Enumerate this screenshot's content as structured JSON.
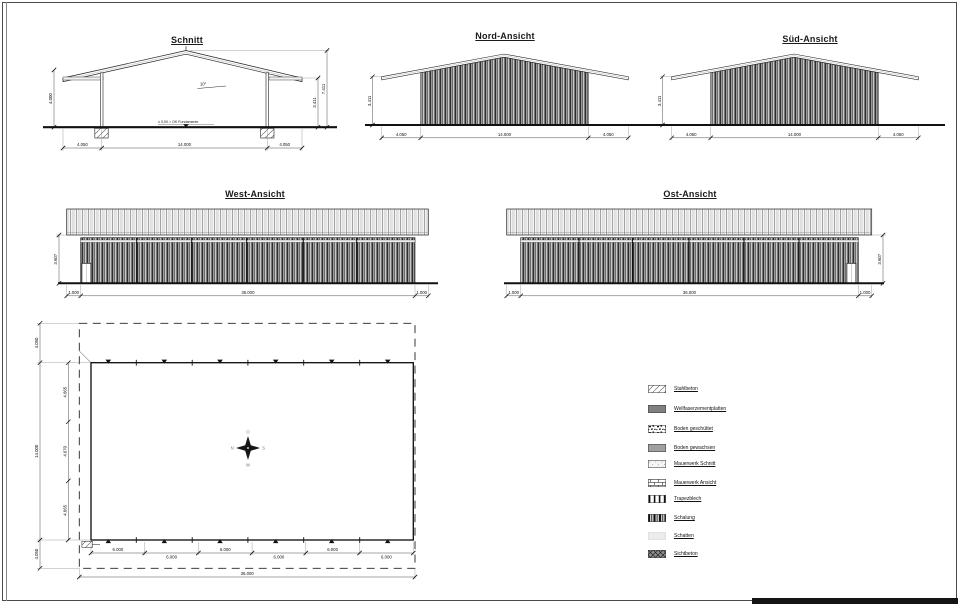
{
  "titles": {
    "schnitt": "Schnitt",
    "nord": "Nord-Ansicht",
    "sued": "Süd-Ansicht",
    "west": "West-Ansicht",
    "ost": "Ost-Ansicht",
    "grundriss": "Grundriss"
  },
  "schnitt": {
    "dims": {
      "bottom": [
        "4.050",
        "14.000",
        "4.050"
      ],
      "left": "4.000",
      "right_total": "7.411",
      "right_wall": "3.411"
    },
    "annotations": {
      "slope": "10°",
      "level": "± 0,00 = OK Fundamente"
    }
  },
  "nord": {
    "dims": {
      "bottom": [
        "4.050",
        "14.000",
        "4.050"
      ],
      "left": "3.411"
    }
  },
  "sued": {
    "dims": {
      "bottom": [
        "4.050",
        "14.000",
        "4.050"
      ],
      "left": "3.411"
    }
  },
  "west": {
    "dims": {
      "bottom": [
        "1.000",
        "36.000",
        "1.000"
      ],
      "left": "3.607"
    }
  },
  "ost": {
    "dims": {
      "bottom": [
        "1.000",
        "36.000",
        "1.000"
      ],
      "right": "3.607"
    }
  },
  "grundriss": {
    "dims": {
      "bottom_segments": [
        "6.000",
        "6.000",
        "6.000",
        "6.000",
        "6.000",
        "6.000"
      ],
      "bottom_total": "36.000",
      "left_outer": [
        "4.050",
        "14.000",
        "4.050"
      ],
      "left_inner": [
        "4.665",
        "4.670",
        "4.665"
      ]
    },
    "compass": {
      "top": "O",
      "right": "S",
      "bottom": "W",
      "left": "N"
    }
  },
  "legend": {
    "items": [
      {
        "label": "Stahlbeton"
      },
      {
        "label": "Wellfaserzementplatten"
      },
      {
        "label": "Boden geschüttet"
      },
      {
        "label": "Boden gewachsen"
      },
      {
        "label": "Mauerwerk Schnitt"
      },
      {
        "label": "Mauerwerk Ansicht"
      },
      {
        "label": "Trapezblech"
      },
      {
        "label": "Schalung"
      },
      {
        "label": "Schatten"
      },
      {
        "label": "Sichtbeton"
      }
    ]
  },
  "colors": {
    "line": "#111111",
    "paper": "#ffffff",
    "frame": "#4a4a4a"
  }
}
